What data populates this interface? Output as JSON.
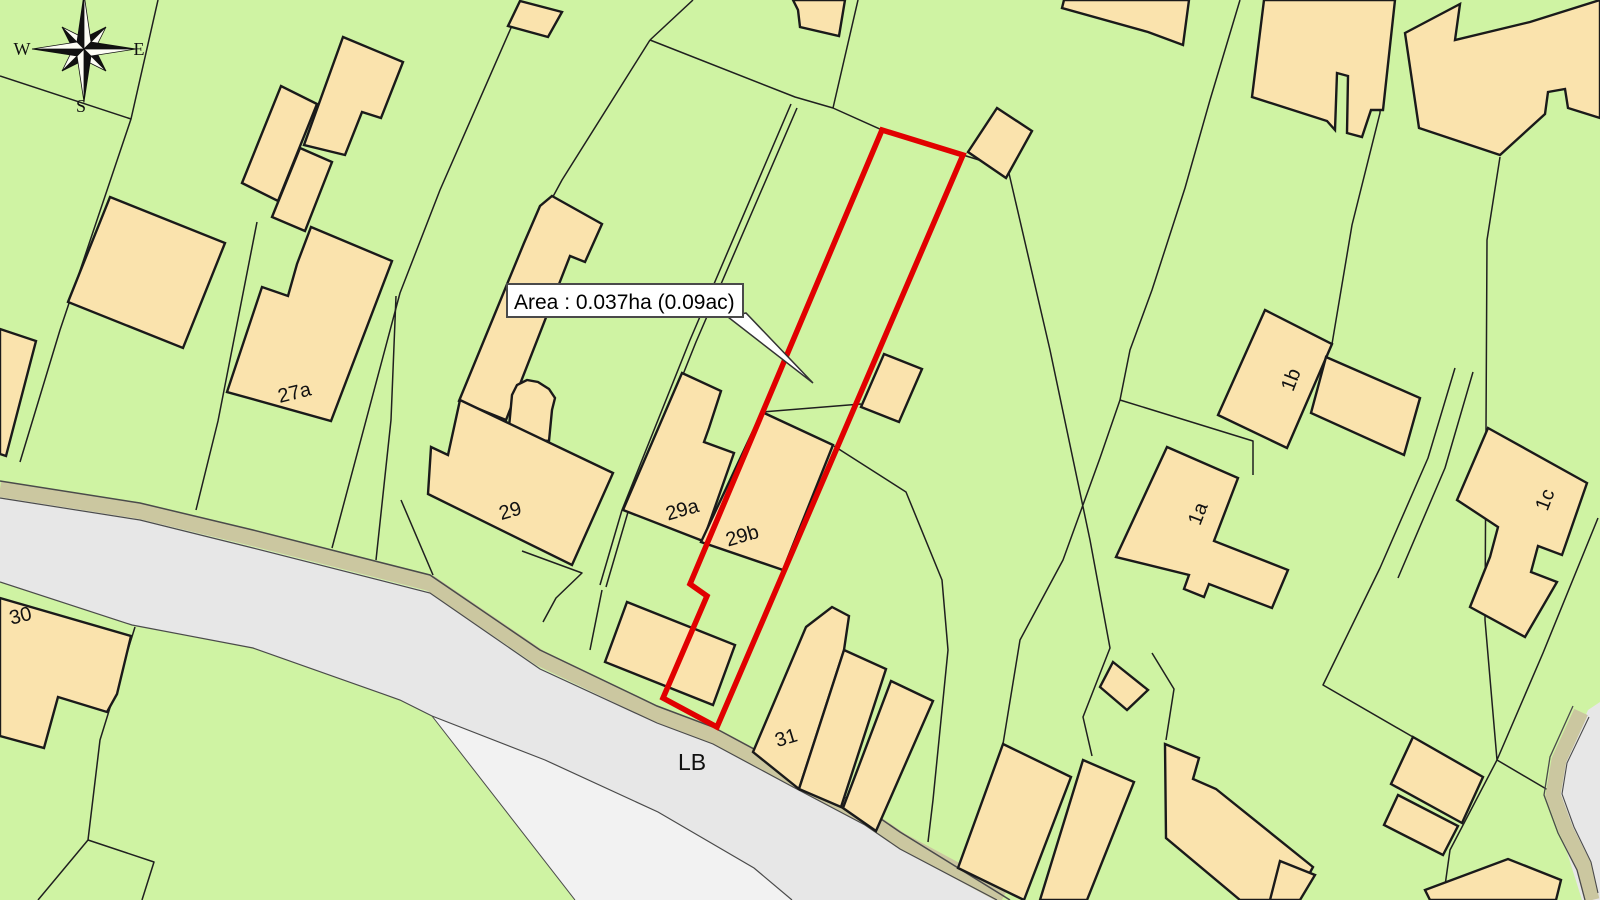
{
  "map": {
    "colors": {
      "background": "#cff3a3",
      "building": "#fae3ad",
      "building_stroke": "#1a1a1a",
      "boundary": "#1f1f1f",
      "road": "#e7e7e7",
      "road_light": "#f2f2f2",
      "verge": "#cbc7a0",
      "road_edge": "#4a4a4a",
      "plot_red": "#e10000",
      "label": "#111111"
    },
    "compass": {
      "west": "W",
      "east": "E",
      "south": "S"
    },
    "area_label": {
      "text": "Area : 0.037ha (0.09ac)"
    },
    "plot": {
      "points": "882,130 963,155 717,727 663,698 707,596 690,584",
      "color": "#e10000",
      "width": 5.5
    },
    "labels": [
      {
        "id": "27a",
        "text": "27a",
        "x": 296,
        "y": 399,
        "r": -14,
        "s": 20
      },
      {
        "id": "29",
        "text": "29",
        "x": 512,
        "y": 517,
        "r": -16,
        "s": 20
      },
      {
        "id": "29a",
        "text": "29a",
        "x": 684,
        "y": 516,
        "r": -16,
        "s": 20
      },
      {
        "id": "29b",
        "text": "29b",
        "x": 744,
        "y": 542,
        "r": -16,
        "s": 20
      },
      {
        "id": "30",
        "text": "30",
        "x": 22,
        "y": 622,
        "r": -14,
        "s": 20
      },
      {
        "id": "31",
        "text": "31",
        "x": 788,
        "y": 744,
        "r": -17,
        "s": 20
      },
      {
        "id": "lb",
        "text": "LB",
        "x": 692,
        "y": 770,
        "r": 0,
        "s": 23
      },
      {
        "id": "1a",
        "text": "1a",
        "x": 1204,
        "y": 516,
        "r": -69,
        "s": 20
      },
      {
        "id": "1b",
        "text": "1b",
        "x": 1297,
        "y": 382,
        "r": -69,
        "s": 20
      },
      {
        "id": "1c",
        "text": "1c",
        "x": 1551,
        "y": 502,
        "r": -69,
        "s": 20
      }
    ],
    "buildings": [
      {
        "id": "tl-slab",
        "points": "242,183 281,86 317,104 278,201"
      },
      {
        "id": "tl-upper",
        "points": "304,145 343,37 403,62 381,118 362,112 345,155"
      },
      {
        "id": "tl-mid",
        "points": "300,148 332,162 305,231 272,217"
      },
      {
        "id": "house-27a",
        "points": "311,227 392,261 331,421 227,392 262,287 288,296 297,264"
      },
      {
        "id": "left-mid",
        "points": "110,197 225,243 183,348 68,302"
      },
      {
        "id": "left-strip",
        "points": "0,329 36,341 6,456 0,454"
      },
      {
        "id": "b29-strip",
        "points": "552,196 602,224 585,262 570,256 506,420 459,401 524,243 540,206"
      },
      {
        "id": "b29-arch",
        "points": "508,438 512,395 517,385 527,380 538,382 549,389 555,398 552,410 549,441"
      },
      {
        "id": "house-29",
        "points": "460,400 613,473 572,565 428,494 431,447 448,455"
      },
      {
        "id": "house-29a",
        "points": "682,373 721,391 709,428 704,442 734,453 703,541 623,510"
      },
      {
        "id": "house-29b",
        "points": "762,412 833,445 783,570 701,542"
      },
      {
        "id": "plot-shed",
        "points": "884,354 922,369 899,422 861,407"
      },
      {
        "id": "road-small",
        "points": "627,602 735,645 713,705 605,662"
      },
      {
        "id": "terrace-u1",
        "points": "806,627 832,607 849,616 844,650 799,789 753,752"
      },
      {
        "id": "terrace-u2",
        "points": "844,650 886,669 841,807 799,789"
      },
      {
        "id": "terrace-u3",
        "points": "891,681 933,701 876,831 843,808"
      },
      {
        "id": "house-u4",
        "points": "1003,744 1071,777 1024,900 958,868"
      },
      {
        "id": "house-u5",
        "points": "1083,760 1134,782 1087,900 1040,900"
      },
      {
        "id": "right-slant",
        "points": "1165,744 1199,758 1193,779 1216,789 1313,867 1295,900 1240,900 1166,838"
      },
      {
        "id": "diamond-mid",
        "points": "1113,662 1148,690 1127,710 1100,687"
      },
      {
        "id": "bottom-small",
        "points": "1280,861 1315,875 1300,900 1270,900"
      },
      {
        "id": "bottom-strip",
        "points": "1425,890 1508,859 1561,880 1556,900 1430,900"
      },
      {
        "id": "garage-1",
        "points": "1413,737 1483,777 1462,823 1391,784"
      },
      {
        "id": "garage-2",
        "points": "1398,795 1458,826 1443,855 1384,825"
      },
      {
        "id": "house-1a",
        "points": "1167,447 1238,478 1214,541 1288,570 1272,608 1209,584 1204,597 1184,589 1189,575 1116,557"
      },
      {
        "id": "house-1b-main",
        "points": "1265,310 1332,344 1287,448 1218,415"
      },
      {
        "id": "house-1b-arm",
        "points": "1326,357 1420,398 1404,455 1311,413"
      },
      {
        "id": "house-1c",
        "points": "1488,428 1587,483 1562,555 1538,546 1531,572 1557,582 1525,637 1470,607 1490,557 1498,527 1457,500"
      },
      {
        "id": "tr-complex-1",
        "points": "1252,97 1264,0 1395,0 1383,110 1371,110 1362,137 1347,133 1348,76 1337,73 1335,130 1327,121"
      },
      {
        "id": "tr-complex-2",
        "points": "1405,33 1460,4 1455,40 1530,22 1600,0 1600,118 1568,108 1565,89 1548,92 1545,114 1500,155 1419,128"
      },
      {
        "id": "tr-small-left",
        "points": "1064,0 1189,0 1183,45 1148,32 1062,8"
      },
      {
        "id": "tr-house-mid",
        "points": "793,0 845,0 839,36 800,27 798,10"
      },
      {
        "id": "top-diamond",
        "points": "520,1 562,12 548,37 508,26"
      },
      {
        "id": "house-30",
        "points": "0,598 131,636 117,694 107,712 58,697 44,748 0,736"
      },
      {
        "id": "red-top-neighbor",
        "points": "997,108 1032,131 1006,178 968,152"
      }
    ],
    "boundaries": [
      {
        "points": "158,0 131,119 60,330 20,462"
      },
      {
        "points": "0,76 131,119"
      },
      {
        "points": "257,222 218,421 196,510"
      },
      {
        "points": "396,296 391,420 376,560"
      },
      {
        "points": "514,21 440,190 400,293 332,548"
      },
      {
        "points": "650,40 562,180 524,250"
      },
      {
        "points": "650,40 795,97 833,108 882,130"
      },
      {
        "points": "858,0 833,108"
      },
      {
        "points": "693,0 650,40"
      },
      {
        "points": "791,104 690,340 622,510 600,585"
      },
      {
        "points": "797,108 696,342 628,512 606,587"
      },
      {
        "points": "963,155 1008,169"
      },
      {
        "points": "1008,169 1050,350 1090,540 1110,648 1083,717 1092,756"
      },
      {
        "points": "1152,653 1174,689 1166,740"
      },
      {
        "points": "1240,0 1210,100 1185,188 1152,290 1130,350 1120,400 1100,458 1063,560 1020,640 1003,744"
      },
      {
        "points": "1120,400 1253,441 1253,475"
      },
      {
        "points": "834,446 906,492 942,580 948,650 933,800 928,842"
      },
      {
        "points": "762,412 861,404"
      },
      {
        "points": "1385,0 1380,113 1352,225 1332,344"
      },
      {
        "points": "1500,157 1487,240 1485,620 1497,760 1450,850 1443,900"
      },
      {
        "points": "1598,518 1543,653 1497,760"
      },
      {
        "points": "1497,760 1548,790"
      },
      {
        "points": "1455,368 1428,458 1380,568 1323,685 1413,737"
      },
      {
        "points": "1473,372 1445,468 1398,578"
      },
      {
        "points": "135,627 100,740 88,840 38,900"
      },
      {
        "points": "88,840 154,862 142,900"
      },
      {
        "points": "522,551 582,573 556,598 543,622"
      },
      {
        "points": "602,590 590,650"
      },
      {
        "points": "401,500 433,575"
      }
    ],
    "road": {
      "surface": "0,497 140,519 253,547 430,592 540,668 657,722 713,743 793,786 865,824 900,848 996,900 792,900 754,868 658,812 545,760 432,716 400,700 253,648 132,625 0,582",
      "junction": "432,716 545,760 658,812 754,868 792,900 575,900",
      "verge_path": "0,489 140,511 253,538 430,583 540,658 657,714 713,735 793,778 865,816 900,840 1004,896",
      "edge_top": "0,481 140,503 253,530 430,575 540,650 657,706 713,727 793,770 865,808 900,832 1010,900",
      "edge_verge_bottom": "0,498 140,520 253,548 430,593 540,669 657,723 713,744 793,787 865,825 900,849 997,900",
      "edge_bottom": "0,582 132,625 253,648 400,700 432,716 545,760 658,812 754,868 792,900",
      "junction_edge": "575,900 432,716",
      "corner_surface": "1588,710 1600,702 1600,900 1582,900 1560,830 1556,795 1568,756",
      "corner_verge": "1581,712 1559,760 1553,795 1566,830 1584,866 1592,900",
      "corner_edge_outer": "1573,706 1550,757 1544,795 1558,833 1577,870 1585,900",
      "corner_edge_inner": "1589,717 1567,763 1562,794 1574,827 1591,862 1598,893"
    }
  }
}
